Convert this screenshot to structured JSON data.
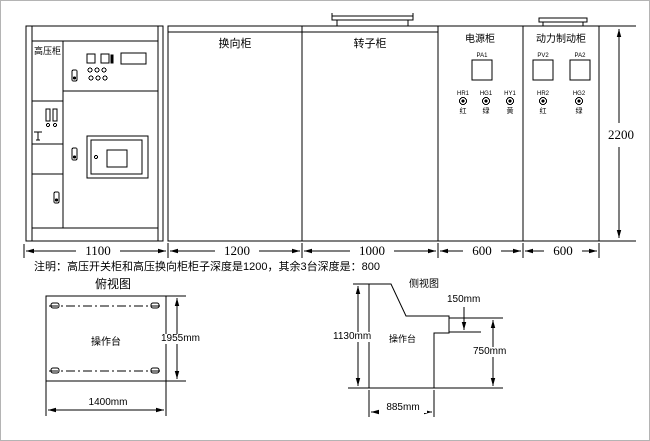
{
  "elevation": {
    "cabinets": [
      {
        "label": "高压柜",
        "width": "1100"
      },
      {
        "label": "换向柜",
        "width": "1200"
      },
      {
        "label": "转子柜",
        "width": "1000"
      },
      {
        "label": "电源柜",
        "width": "600"
      },
      {
        "label": "动力制动柜",
        "width": "600"
      }
    ],
    "height": "2200",
    "power_cabinet": {
      "meter_tag": "PA1",
      "lamps": [
        {
          "tag": "HR1",
          "char": "红"
        },
        {
          "tag": "HG1",
          "char": "绿"
        },
        {
          "tag": "HY1",
          "char": "黄"
        }
      ]
    },
    "brake_cabinet": {
      "meter_tags": [
        "PV2",
        "PA2"
      ],
      "lamps": [
        {
          "tag": "HR2",
          "char": "红"
        },
        {
          "tag": "HG2",
          "char": "绿"
        }
      ]
    }
  },
  "note": "注明：高压开关柜和高压换向柜柜子深度是1200，其余3台深度是：800",
  "top_view": {
    "title": "俯视图",
    "unit_label": "操作台",
    "depth_dim": "1955mm",
    "width_dim": "1400mm"
  },
  "side_view": {
    "title": "侧视图",
    "unit_label": "操作台",
    "height_dim": "1130mm",
    "step_dim": "150mm",
    "front_dim": "750mm",
    "depth_dim": "885mm"
  }
}
